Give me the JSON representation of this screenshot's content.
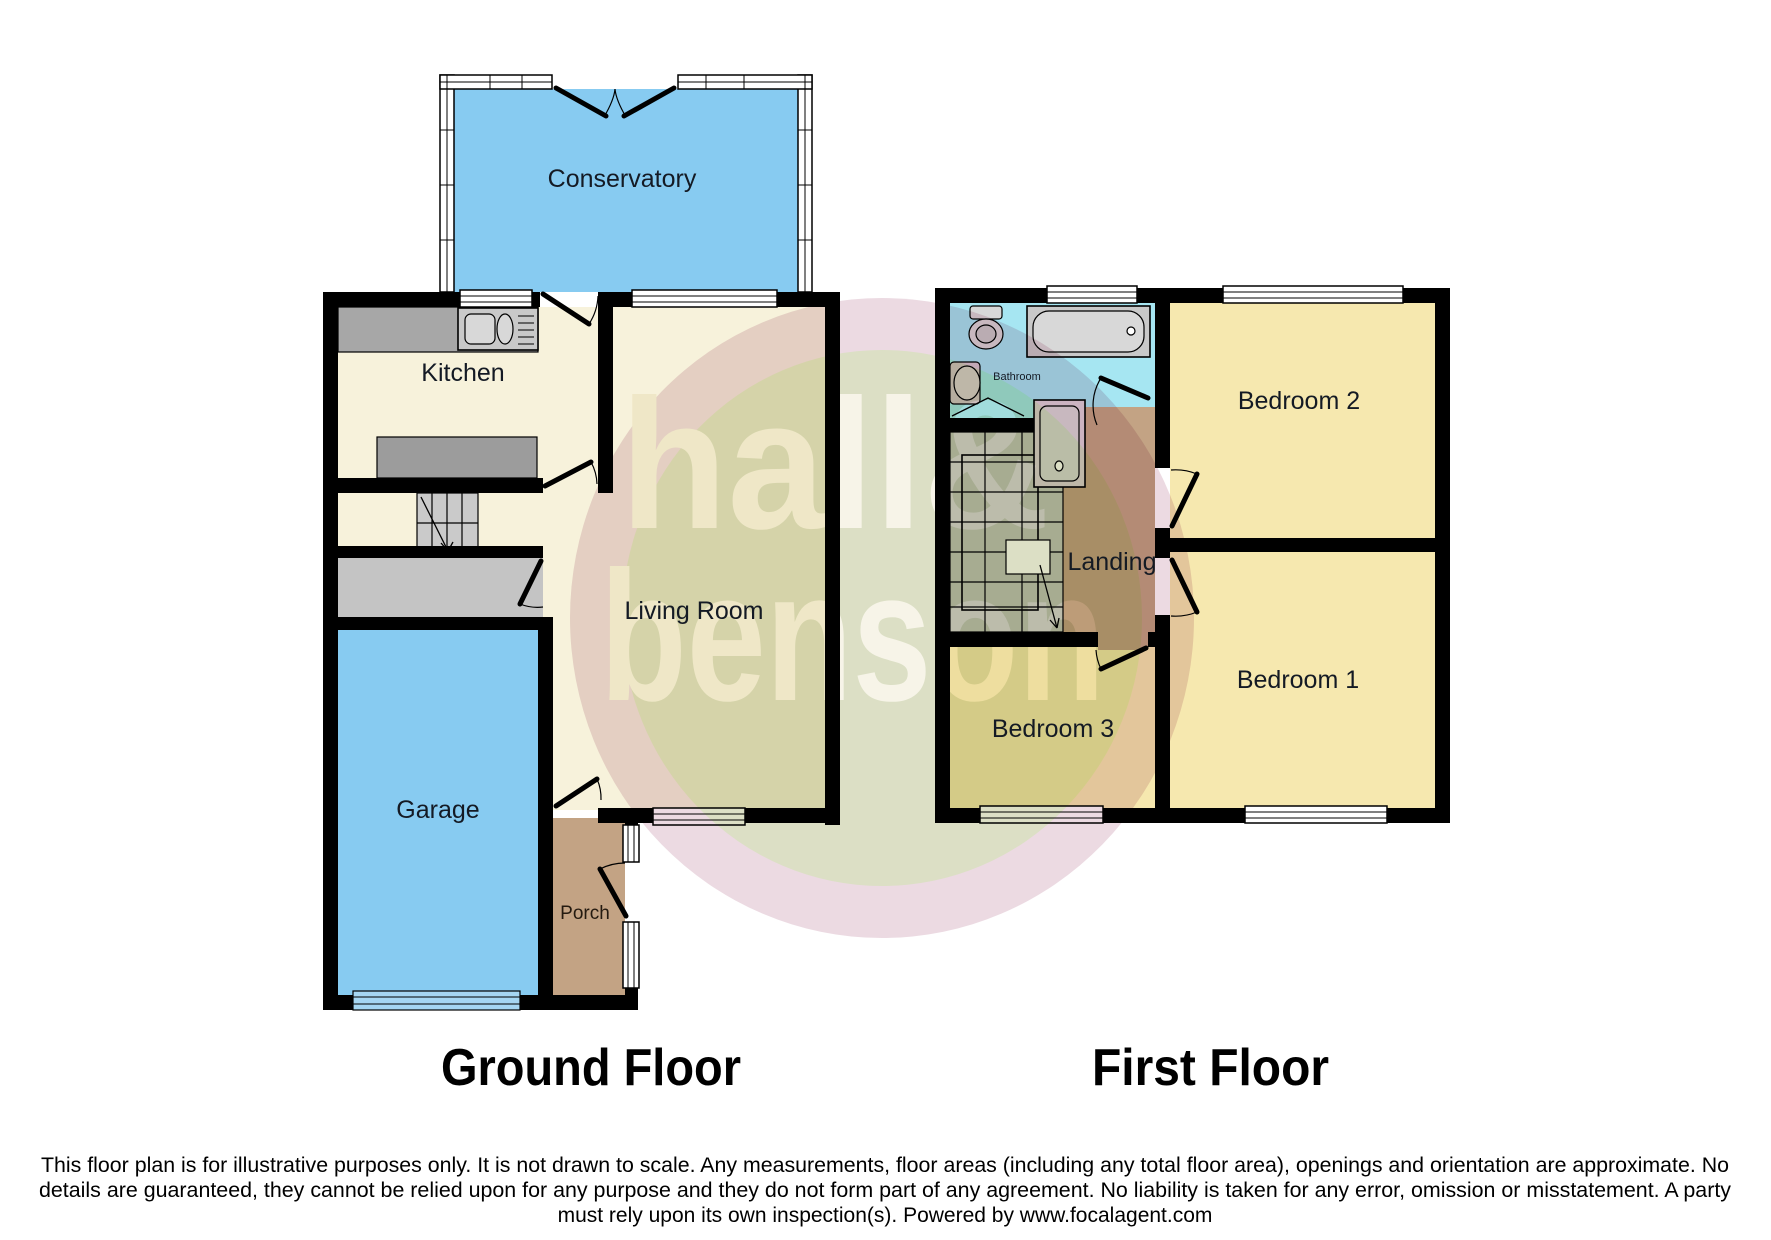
{
  "watermark": {
    "word1": "hall&",
    "word2": "benson"
  },
  "ground_floor": {
    "title": "Ground Floor",
    "rooms": {
      "conservatory": "Conservatory",
      "kitchen": "Kitchen",
      "living_room": "Living Room",
      "garage": "Garage",
      "porch": "Porch"
    }
  },
  "first_floor": {
    "title": "First Floor",
    "rooms": {
      "bathroom": "Bathroom",
      "bedroom2": "Bedroom 2",
      "landing": "Landing",
      "bedroom1": "Bedroom 1",
      "bedroom3": "Bedroom 3"
    }
  },
  "disclaimer": {
    "lines": [
      "This floor plan is for illustrative purposes only. It is not drawn to scale. Any measurements, floor areas (including any total floor area), openings and orientation are approximate. No",
      "details are guaranteed, they cannot be relied upon for any purpose and they do not form part of any agreement. No liability is taken for any error, omission or misstatement. A party",
      "must rely upon its own inspection(s). Powered by www.focalagent.com"
    ]
  },
  "colors": {
    "wall": "#000000",
    "room_cream": "#F7F2DB",
    "blue_room": "#87CBF1",
    "bedroom_yellow": "#F6E8AF",
    "bathroom_cyan": "#A6E6F2",
    "brown": "#C3A384",
    "store_gray": "#C4C4C4",
    "counter_gray": "#A7A7A7",
    "island_gray": "#9C9C9C",
    "stair_gray": "#CACACA",
    "stair_gray_first": "#C2C5BC",
    "fixture_light": "#D8D8D8",
    "fixture_mid": "#C9C9C9",
    "shower_fill": "#DCD2DA",
    "sink_fill": "#D3C6CE",
    "garage_door_blue": "#A5D6F2",
    "window_white": "#FFFFFF",
    "watermark_ring": "#E0C4D0",
    "watermark_inner": "#C6CCA1",
    "watermark_text": "#F2EEDA"
  }
}
